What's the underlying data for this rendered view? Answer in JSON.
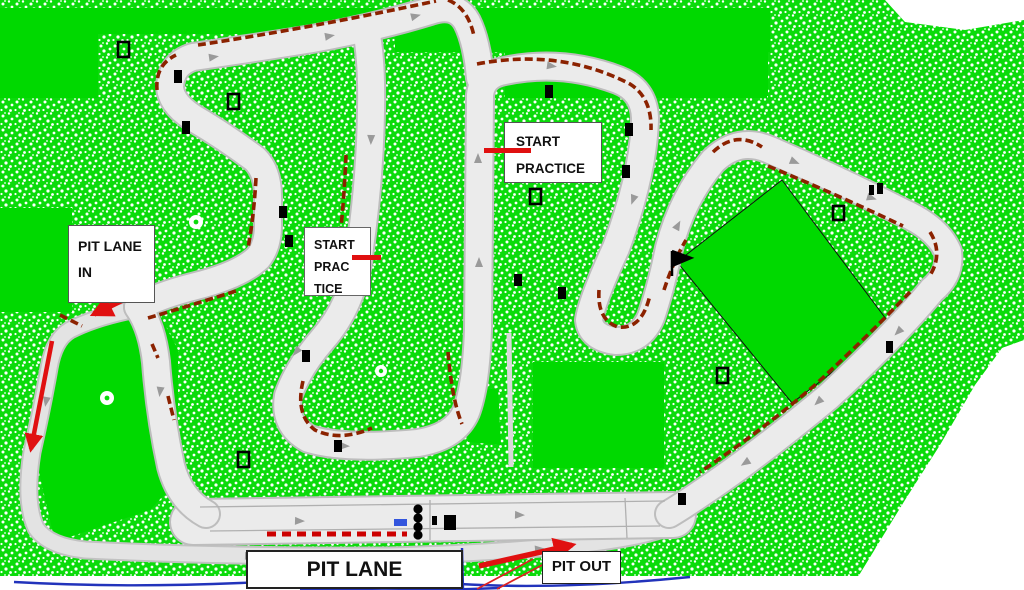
{
  "map": {
    "title": "kart-circuit-track-map",
    "labels": {
      "pit_lane_in": {
        "line1": "PIT LANE",
        "line2": "IN"
      },
      "start_practice_upper": {
        "line1": "START",
        "line2": "PRACTICE"
      },
      "start_practice_lower": {
        "line1": "START",
        "line2": "PRAC",
        "line3": "TICE"
      },
      "pit_lane": "PIT LANE",
      "pit_out": "PIT OUT"
    },
    "colors": {
      "grass_green": "#0be00b",
      "solid_green": "#00d900",
      "track_gray": "#ebebeb",
      "track_edge_gray": "#bdbdbd",
      "curb_maroon": "#8b2200",
      "start_curb_red": "#cc0000",
      "marking_red": "#e01010",
      "boundary_blue": "#2233bb",
      "label_text": "#111111"
    }
  }
}
